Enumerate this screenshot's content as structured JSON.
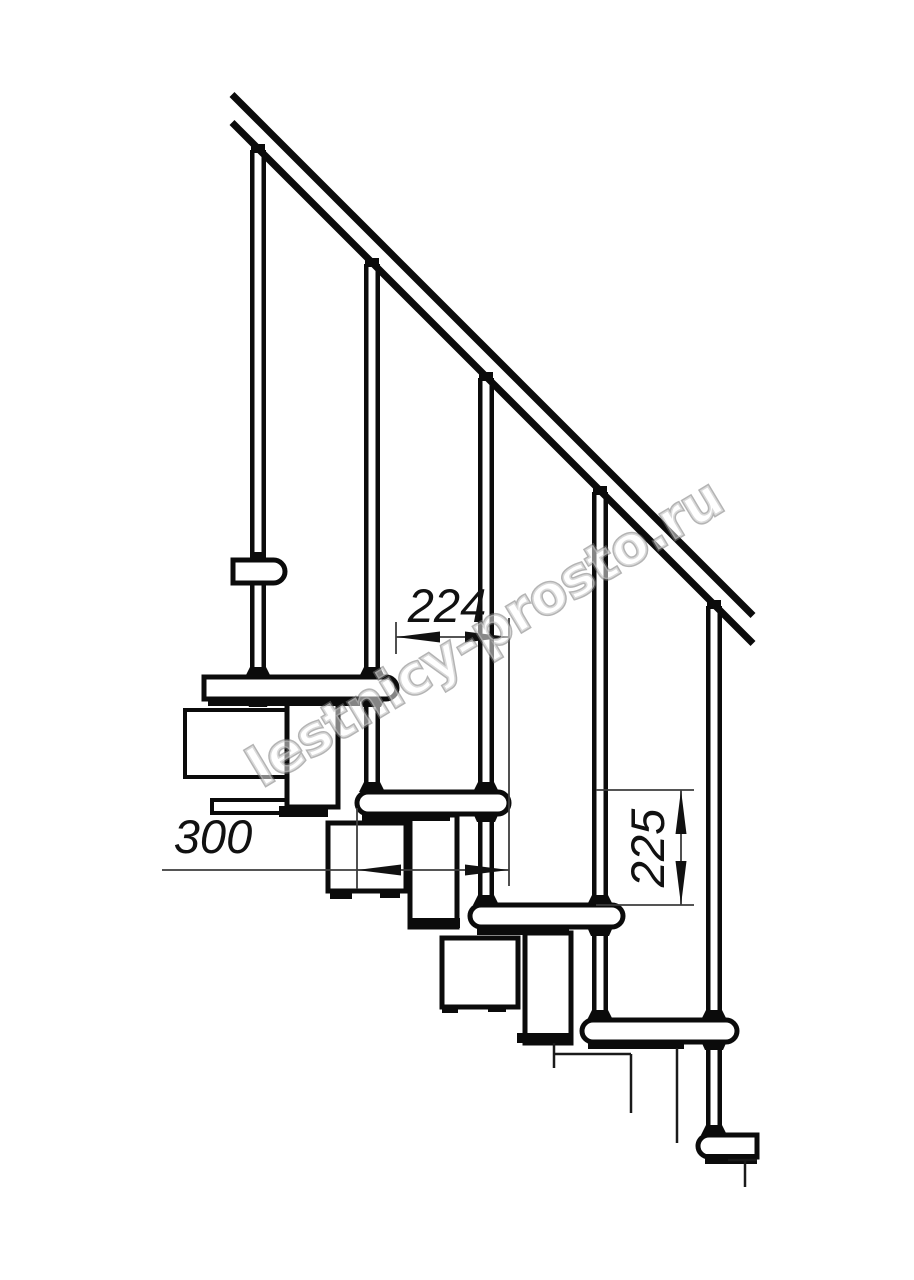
{
  "watermark": {
    "text": "lestnicy-prosto.ru",
    "angle_deg": -31,
    "anchor_x": 262,
    "anchor_y": 788,
    "font_size": 54
  },
  "dimensions": {
    "step_run_label": "224",
    "tread_depth_label": "300",
    "riser_height_label": "225"
  },
  "colors": {
    "line": "#0b0b0b",
    "thin_line": "#3d3d3d",
    "fill": "#ffffff",
    "text": "#111111"
  },
  "drawing": {
    "rail": {
      "stroke_w": 7,
      "lines": [
        {
          "x1": 232,
          "y1": 94.5,
          "x2": 753,
          "y2": 615.5
        },
        {
          "x1": 232,
          "y1": 122.5,
          "x2": 753,
          "y2": 643.5
        }
      ]
    },
    "balusters": {
      "edge_w": 4.5,
      "items": [
        {
          "x1": 250,
          "x2": 266,
          "yTop": 150,
          "yBot": 677
        },
        {
          "x1": 364,
          "x2": 380,
          "yTop": 264,
          "yBot": 792
        },
        {
          "x1": 478,
          "x2": 494,
          "yTop": 378,
          "yBot": 905
        },
        {
          "x1": 592,
          "x2": 608,
          "yTop": 492,
          "yBot": 1020
        },
        {
          "x1": 706,
          "x2": 722,
          "yTop": 606,
          "yBot": 1135
        }
      ]
    },
    "boxes": [
      {
        "x": 185,
        "y": 710,
        "w": 104,
        "h": 67,
        "sw": 4
      },
      {
        "x": 212,
        "y": 800,
        "w": 80,
        "h": 13,
        "sw": 4
      },
      {
        "x": 287,
        "y": 701,
        "w": 51,
        "h": 106,
        "sw": 5
      },
      {
        "x": 410,
        "y": 815,
        "w": 47,
        "h": 112,
        "sw": 5
      },
      {
        "x": 525,
        "y": 933,
        "w": 46,
        "h": 110,
        "sw": 5
      },
      {
        "x": 328,
        "y": 823,
        "w": 78,
        "h": 68,
        "sw": 5
      },
      {
        "x": 442,
        "y": 938,
        "w": 76,
        "h": 69,
        "sw": 5
      }
    ],
    "treads": [
      {
        "x": 204,
        "y": 677,
        "w": 193,
        "h": 22,
        "rl": 0,
        "rr": 1
      },
      {
        "x": 357,
        "y": 792,
        "w": 152,
        "h": 22,
        "rl": 1,
        "rr": 1
      },
      {
        "x": 470,
        "y": 905,
        "w": 153,
        "h": 22,
        "rl": 1,
        "rr": 1
      },
      {
        "x": 582,
        "y": 1020,
        "w": 155,
        "h": 22,
        "rl": 1,
        "rr": 1
      },
      {
        "x": 698,
        "y": 1135,
        "w": 59,
        "h": 22,
        "rl": 1,
        "rr": 0
      },
      {
        "x": 233,
        "y": 560,
        "w": 52,
        "h": 23,
        "rl": 0,
        "rr": 1
      }
    ],
    "strips": [
      {
        "x": 208,
        "y": 698,
        "w": 152,
        "h": 8
      },
      {
        "x": 362,
        "y": 813,
        "w": 88,
        "h": 8
      },
      {
        "x": 477,
        "y": 927,
        "w": 92,
        "h": 8
      },
      {
        "x": 588,
        "y": 1041,
        "w": 96,
        "h": 8
      },
      {
        "x": 705,
        "y": 1154,
        "w": 52,
        "h": 10
      }
    ],
    "flanges": [
      {
        "x": 279,
        "y": 806,
        "w": 49,
        "h": 11
      },
      {
        "x": 412,
        "y": 918,
        "w": 48,
        "h": 10
      },
      {
        "x": 517,
        "y": 1033,
        "w": 53,
        "h": 10
      },
      {
        "x": 330,
        "y": 890,
        "w": 22,
        "h": 9
      },
      {
        "x": 380,
        "y": 890,
        "w": 20,
        "h": 8
      },
      {
        "x": 442,
        "y": 1006,
        "w": 16,
        "h": 7
      },
      {
        "x": 488,
        "y": 1005,
        "w": 18,
        "h": 7
      }
    ],
    "caps": [
      {
        "cx": 258,
        "y": 144
      },
      {
        "cx": 372,
        "y": 258
      },
      {
        "cx": 486,
        "y": 372
      },
      {
        "cx": 600,
        "y": 486
      },
      {
        "cx": 714,
        "y": 600
      },
      {
        "cx": 258,
        "y": 552
      }
    ],
    "feet": [
      {
        "cx": 258,
        "y": 667
      },
      {
        "cx": 372,
        "y": 667
      },
      {
        "cx": 372,
        "y": 782
      },
      {
        "cx": 486,
        "y": 782
      },
      {
        "cx": 486,
        "y": 895
      },
      {
        "cx": 600,
        "y": 895
      },
      {
        "cx": 600,
        "y": 1010
      },
      {
        "cx": 714,
        "y": 1010
      },
      {
        "cx": 714,
        "y": 1125
      }
    ],
    "nuts": [
      {
        "cx": 258,
        "y": 698
      },
      {
        "cx": 372,
        "y": 698
      },
      {
        "cx": 486,
        "y": 813
      },
      {
        "cx": 600,
        "y": 927
      },
      {
        "cx": 714,
        "y": 1041
      }
    ],
    "cut_lines": [
      {
        "x1": 554,
        "y1": 1043,
        "x2": 554,
        "y2": 1068
      },
      {
        "x1": 553,
        "y1": 1054,
        "x2": 631,
        "y2": 1054
      },
      {
        "x1": 631,
        "y1": 1054,
        "x2": 631,
        "y2": 1113
      },
      {
        "x1": 677,
        "y1": 1048,
        "x2": 677,
        "y2": 1143
      },
      {
        "x1": 728,
        "y1": 1160,
        "x2": 757,
        "y2": 1160
      },
      {
        "x1": 745,
        "y1": 1160,
        "x2": 745,
        "y2": 1187
      }
    ],
    "dims": [
      {
        "key": "step_run_label",
        "name": "dimension-224",
        "line": {
          "x1": 396,
          "y1": 637,
          "x2": 509,
          "y2": 637
        },
        "exts": [
          {
            "x1": 396,
            "y1": 622,
            "x2": 396,
            "y2": 654
          },
          {
            "x1": 509,
            "y1": 618,
            "x2": 509,
            "y2": 886
          }
        ],
        "arrows": [
          {
            "tx": 396,
            "ty": 637,
            "dir": "left"
          },
          {
            "tx": 509,
            "ty": 637,
            "dir": "right"
          }
        ],
        "label": {
          "x": 447,
          "y": 622,
          "rot": 0
        }
      },
      {
        "key": "tread_depth_label",
        "name": "dimension-300",
        "line": {
          "x1": 162,
          "y1": 870,
          "x2": 509,
          "y2": 870
        },
        "exts": [
          {
            "x1": 357,
            "y1": 808,
            "x2": 357,
            "y2": 889
          }
        ],
        "arrows": [
          {
            "tx": 357,
            "ty": 870,
            "dir": "left"
          },
          {
            "tx": 509,
            "ty": 870,
            "dir": "right"
          }
        ],
        "label": {
          "x": 213,
          "y": 853,
          "rot": 0
        }
      },
      {
        "key": "riser_height_label",
        "name": "dimension-225",
        "line": {
          "x1": 681,
          "y1": 790,
          "x2": 681,
          "y2": 905
        },
        "exts": [
          {
            "x1": 596,
            "y1": 790,
            "x2": 694,
            "y2": 790
          },
          {
            "x1": 596,
            "y1": 905,
            "x2": 694,
            "y2": 905
          }
        ],
        "arrows": [
          {
            "tx": 681,
            "ty": 790,
            "dir": "up"
          },
          {
            "tx": 681,
            "ty": 905,
            "dir": "down"
          }
        ],
        "label": {
          "x": 664,
          "y": 848,
          "rot": -90
        }
      }
    ]
  }
}
